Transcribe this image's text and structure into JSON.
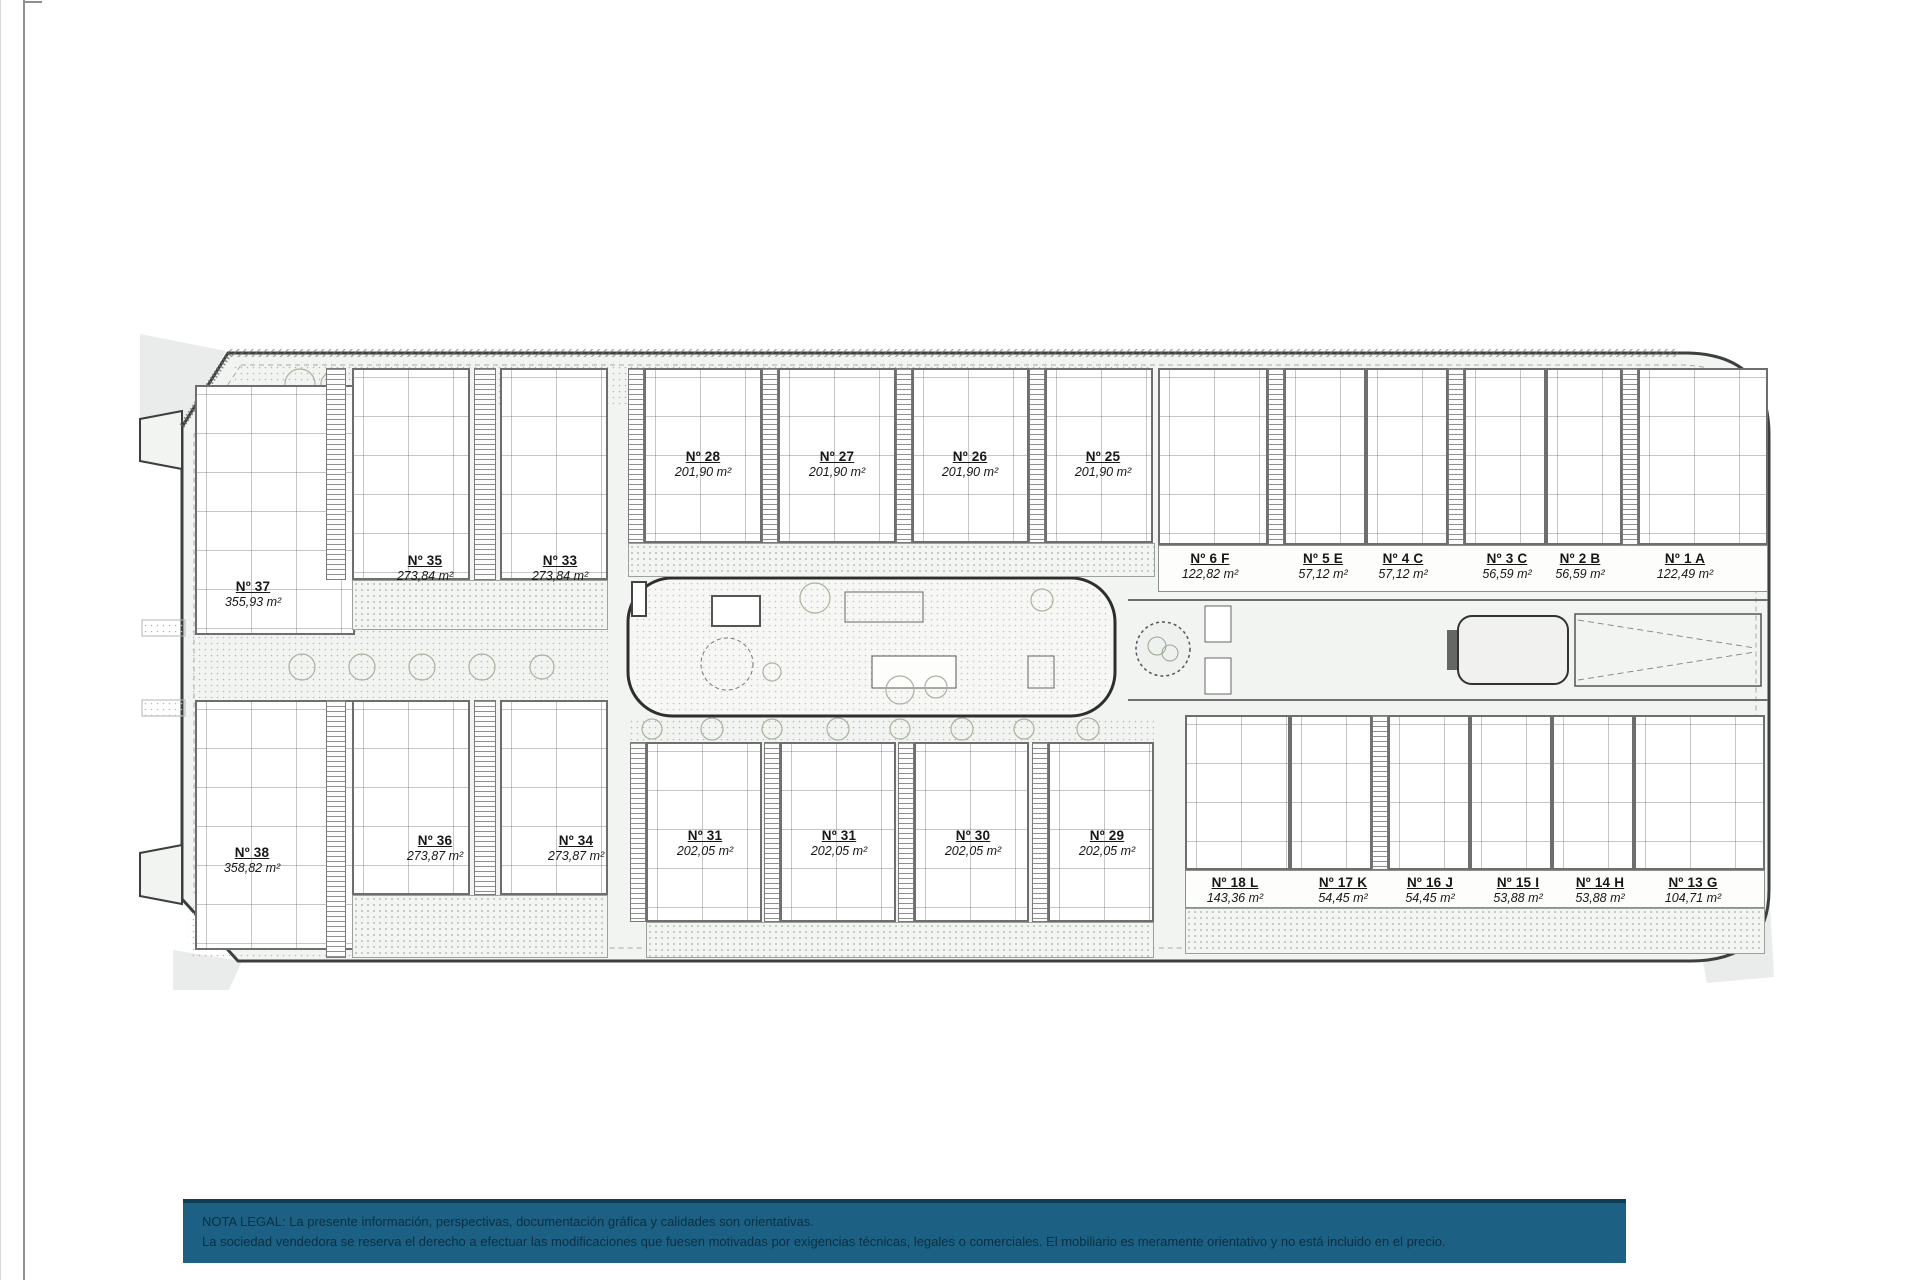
{
  "legal_note": {
    "line1": "NOTA LEGAL: La presente información, perspectivas, documentación gráfica y calidades son orientativas.",
    "line2": "La sociedad vendedora se reserva el derecho a efectuar las modificaciones que fuesen motivadas por exigencias técnicas, legales o comerciales. El mobiliario es meramente orientativo y no está incluido en el precio."
  },
  "colors": {
    "banner_bg": "#1c6183",
    "banner_border": "#0f3d55",
    "banner_text": "#0c2f42",
    "site_outline": "#3c3f3f",
    "site_fill": "#f2f4f2"
  },
  "plan": {
    "units": [
      {
        "number": "Nº 37",
        "area": "355,93 m²"
      },
      {
        "number": "Nº 35",
        "area": "273,84 m²"
      },
      {
        "number": "Nº 33",
        "area": "273,84 m²"
      },
      {
        "number": "Nº 28",
        "area": "201,90 m²"
      },
      {
        "number": "Nº 27",
        "area": "201,90 m²"
      },
      {
        "number": "Nº 26",
        "area": "201,90 m²"
      },
      {
        "number": "Nº 25",
        "area": "201,90 m²"
      },
      {
        "number": "Nº 6 F",
        "area": "122,82 m²"
      },
      {
        "number": "Nº 5 E",
        "area": "57,12 m²"
      },
      {
        "number": "Nº 4 C",
        "area": "57,12 m²"
      },
      {
        "number": "Nº 3 C",
        "area": "56,59 m²"
      },
      {
        "number": "Nº 2 B",
        "area": "56,59 m²"
      },
      {
        "number": "Nº 1 A",
        "area": "122,49 m²"
      },
      {
        "number": "Nº 38",
        "area": "358,82 m²"
      },
      {
        "number": "Nº 36",
        "area": "273,87 m²"
      },
      {
        "number": "Nº 34",
        "area": "273,87 m²"
      },
      {
        "number": "Nº 31",
        "area": "202,05 m²"
      },
      {
        "number": "Nº 31",
        "area": "202,05 m²"
      },
      {
        "number": "Nº 30",
        "area": "202,05 m²"
      },
      {
        "number": "Nº 29",
        "area": "202,05 m²"
      },
      {
        "number": "Nº 18 L",
        "area": "143,36 m²"
      },
      {
        "number": "Nº 17 K",
        "area": "54,45 m²"
      },
      {
        "number": "Nº 16 J",
        "area": "54,45 m²"
      },
      {
        "number": "Nº 15 I",
        "area": "53,88 m²"
      },
      {
        "number": "Nº 14 H",
        "area": "53,88 m²"
      },
      {
        "number": "Nº 13 G",
        "area": "104,71 m²"
      }
    ]
  }
}
